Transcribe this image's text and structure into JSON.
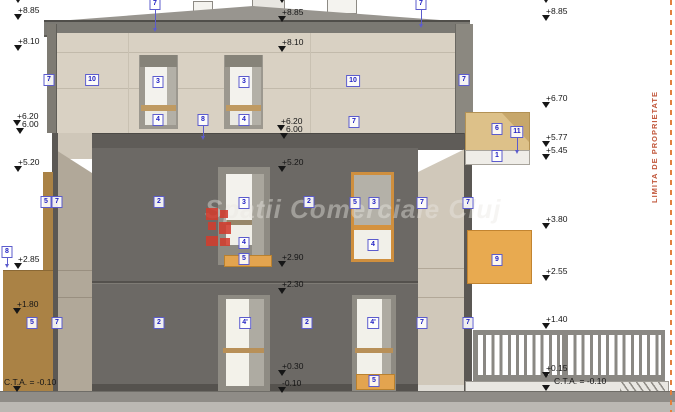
{
  "watermark": {
    "text": "Spatii Comerciale Cluj"
  },
  "property_line": {
    "label": "LIMITA DE PROPRIETATE"
  },
  "colors": {
    "facade_dark": "#6c6965",
    "wall_beige": "#d9d1c3",
    "side_wall": "#cfc7b9",
    "accent_orange": "#e8aa50",
    "window_frame_orange": "#cf8f3e",
    "brown_wall": "#aa8245",
    "ref_box_blue": "#2222c4",
    "property_line_red": "#c2583c",
    "logo_red": "#d23c2d",
    "roof_gray": "#7b7973"
  },
  "elevation_markers": [
    {
      "type": "tri",
      "x": 14,
      "y": -3
    },
    {
      "label": "+8.85",
      "x": 14,
      "y": 6
    },
    {
      "label": "+8.10",
      "x": 14,
      "y": 37
    },
    {
      "label": "+6.20",
      "type": "t",
      "x": 13,
      "y": 112
    },
    {
      "label": "6.00",
      "type": "lr",
      "x": 13,
      "y": 120
    },
    {
      "type": "tri",
      "x": 16,
      "y": 128
    },
    {
      "label": "+5.20",
      "x": 14,
      "y": 158
    },
    {
      "label": "+2.85",
      "x": 14,
      "y": 255
    },
    {
      "label": "+1.80",
      "x": 13,
      "y": 300
    },
    {
      "label": "C.T.A. = -0.10",
      "x": 13,
      "y": 378,
      "dx": -9
    },
    {
      "type": "tri",
      "x": 278,
      "y": -3
    },
    {
      "label": "+8.85",
      "x": 278,
      "y": 8
    },
    {
      "label": "+8.10",
      "x": 278,
      "y": 38
    },
    {
      "label": "+6.20",
      "type": "t",
      "x": 277,
      "y": 117
    },
    {
      "label": "6.00",
      "type": "lr",
      "x": 277,
      "y": 125
    },
    {
      "type": "tri",
      "x": 280,
      "y": 133
    },
    {
      "label": "+5.20",
      "x": 278,
      "y": 158
    },
    {
      "label": "+2.90",
      "x": 278,
      "y": 253
    },
    {
      "label": "+2.30",
      "x": 278,
      "y": 280
    },
    {
      "label": "+0.30",
      "x": 278,
      "y": 362
    },
    {
      "label": "-0.10",
      "x": 278,
      "y": 379
    },
    {
      "type": "tri",
      "x": 542,
      "y": -3
    },
    {
      "label": "+8.85",
      "x": 542,
      "y": 7
    },
    {
      "label": "+6.70",
      "x": 542,
      "y": 94
    },
    {
      "label": "+5.77",
      "x": 542,
      "y": 133
    },
    {
      "label": "+5.45",
      "x": 542,
      "y": 146
    },
    {
      "label": "+3.80",
      "x": 542,
      "y": 215
    },
    {
      "label": "+2.55",
      "x": 542,
      "y": 267
    },
    {
      "label": "+1.40",
      "x": 542,
      "y": 315
    },
    {
      "label": "+0.15",
      "x": 542,
      "y": 364
    },
    {
      "label": "C.T.A. = -0.10",
      "x": 542,
      "y": 377,
      "dx": 12
    }
  ],
  "ref_boxes": [
    {
      "label": "7",
      "x": 155,
      "y": 4,
      "leader": 20
    },
    {
      "label": "7",
      "x": 421,
      "y": 4,
      "leader": 16
    },
    {
      "label": "7",
      "x": 49,
      "y": 80
    },
    {
      "label": "10",
      "x": 92,
      "y": 80
    },
    {
      "label": "3",
      "x": 158,
      "y": 82
    },
    {
      "label": "4",
      "x": 158,
      "y": 120
    },
    {
      "label": "3",
      "x": 244,
      "y": 82
    },
    {
      "label": "4",
      "x": 244,
      "y": 120
    },
    {
      "label": "8",
      "x": 203,
      "y": 120,
      "leader": 12
    },
    {
      "label": "10",
      "x": 353,
      "y": 81
    },
    {
      "label": "7",
      "x": 354,
      "y": 122
    },
    {
      "label": "7",
      "x": 464,
      "y": 80
    },
    {
      "label": "6",
      "x": 497,
      "y": 129
    },
    {
      "label": "11",
      "x": 517,
      "y": 132,
      "leader": 14
    },
    {
      "label": "1",
      "x": 497,
      "y": 156
    },
    {
      "label": "8",
      "x": 7,
      "y": 252,
      "leader": 8
    },
    {
      "label": "5",
      "x": 46,
      "y": 202
    },
    {
      "label": "7",
      "x": 57,
      "y": 202
    },
    {
      "label": "2",
      "x": 159,
      "y": 202
    },
    {
      "label": "3",
      "x": 244,
      "y": 203
    },
    {
      "label": "4",
      "x": 244,
      "y": 243
    },
    {
      "label": "5",
      "x": 244,
      "y": 259
    },
    {
      "label": "2",
      "x": 309,
      "y": 202
    },
    {
      "label": "5",
      "x": 355,
      "y": 203
    },
    {
      "label": "3",
      "x": 374,
      "y": 203
    },
    {
      "label": "4",
      "x": 373,
      "y": 245
    },
    {
      "label": "7",
      "x": 422,
      "y": 203
    },
    {
      "label": "7",
      "x": 468,
      "y": 203
    },
    {
      "label": "9",
      "x": 497,
      "y": 260
    },
    {
      "label": "5",
      "x": 32,
      "y": 323
    },
    {
      "label": "7",
      "x": 57,
      "y": 323
    },
    {
      "label": "2",
      "x": 159,
      "y": 323
    },
    {
      "label": "4'",
      "x": 245,
      "y": 323
    },
    {
      "label": "2",
      "x": 307,
      "y": 323
    },
    {
      "label": "4'",
      "x": 373,
      "y": 323
    },
    {
      "label": "7",
      "x": 422,
      "y": 323
    },
    {
      "label": "7",
      "x": 468,
      "y": 323
    },
    {
      "label": "5",
      "x": 374,
      "y": 381
    }
  ]
}
